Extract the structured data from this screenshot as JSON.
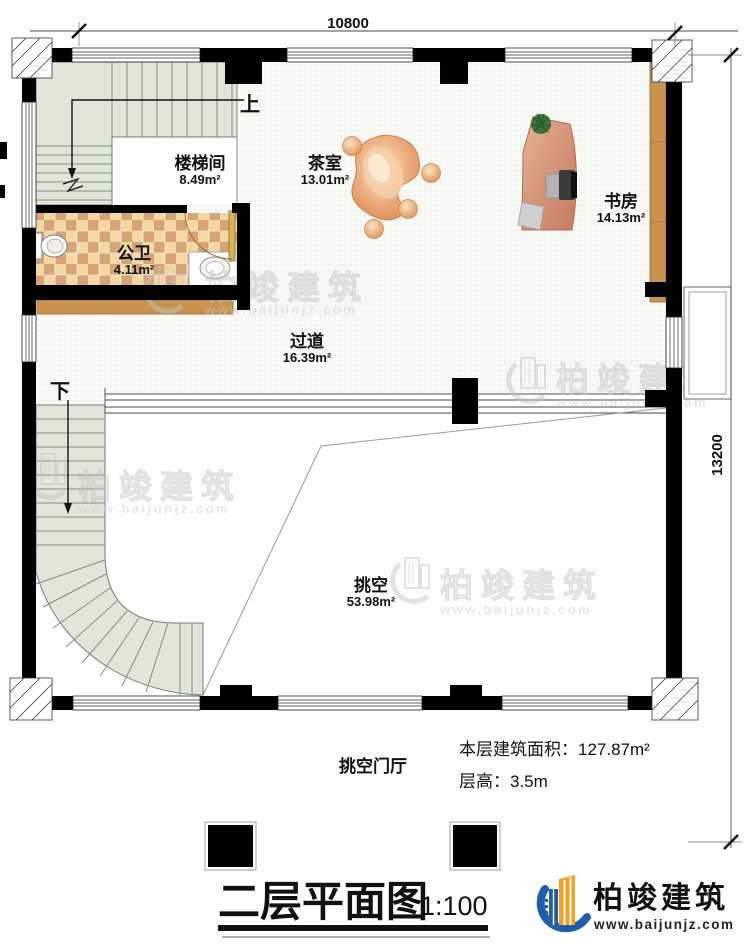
{
  "dimensions": {
    "top": "10800",
    "right": "13200"
  },
  "rooms": {
    "stairwell": {
      "name": "楼梯间",
      "area": "8.49m²"
    },
    "tea": {
      "name": "茶室",
      "area": "13.01m²"
    },
    "study": {
      "name": "书房",
      "area": "14.13m²"
    },
    "bath": {
      "name": "公卫",
      "area": "4.11m²"
    },
    "corridor": {
      "name": "过道",
      "area": "16.39m²"
    },
    "void": {
      "name": "挑空",
      "area": "53.98m²"
    }
  },
  "stairs": {
    "up": "上",
    "down": "下"
  },
  "annotations": {
    "foyer": "挑空门厅",
    "floor_area_label": "本层建筑面积：",
    "floor_area_value": "127.87m²",
    "floor_height_label": "层高：",
    "floor_height_value": "3.5m"
  },
  "title": {
    "text": "二层平面图",
    "scale": "1:100"
  },
  "brand": {
    "name": "柏竣建筑",
    "url": "www.baijunjz.com"
  },
  "watermark": {
    "name": "柏竣建筑",
    "url": "www.baijunjz.com"
  },
  "colors": {
    "wall": "#000000",
    "stair_green": "#e0e6da",
    "tile_light": "#f3d8a4",
    "tile_dark": "#d7a477",
    "wood": "#c8934e",
    "furniture_orange": "#e09a62",
    "logo_blue": "#1d5fae",
    "logo_orange": "#f5a11c"
  }
}
